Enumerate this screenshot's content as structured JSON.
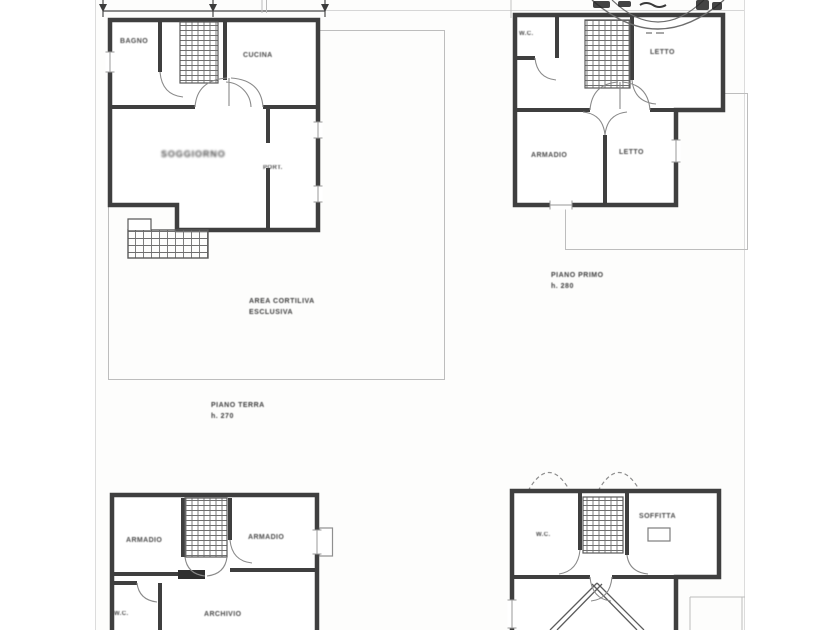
{
  "palette": {
    "paper": "#ffffff",
    "wall_ink": "#3f3f3f",
    "thin_line": "#bdbdbd",
    "hatch": "#6f6f6f",
    "label_ink": "#4b4b4b",
    "stamp_ink": "#242424"
  },
  "icons": {
    "stamp": "partial-circular-rubber-stamp",
    "stairs": "grid-hatch-staircase",
    "dimension_marks": "arrowhead-ticks"
  },
  "plans": {
    "ground_floor": {
      "rooms": {
        "bagno": "BAGNO",
        "cucina": "CUCINA",
        "soggiorno": "SOGGIORNO",
        "portico": "PORT.",
        "area_note_1": "AREA CORTILIVA",
        "area_note_2": "ESCLUSIVA"
      },
      "caption_1": "PIANO TERRA",
      "caption_2": "h. 270"
    },
    "first_floor": {
      "rooms": {
        "wc": "W.C.",
        "letto_1": "LETTO",
        "armadio": "ARMADIO",
        "letto_2": "LETTO"
      },
      "caption_1": "PIANO PRIMO",
      "caption_2": "h. 280"
    },
    "lower_left": {
      "rooms": {
        "armadio_1": "ARMADIO",
        "armadio_2": "ARMADIO",
        "wc": "W.C.",
        "archivio": "ARCHIVIO"
      }
    },
    "lower_right": {
      "rooms": {
        "wc": "W.C.",
        "soffitta": "SOFFITTA"
      }
    }
  }
}
